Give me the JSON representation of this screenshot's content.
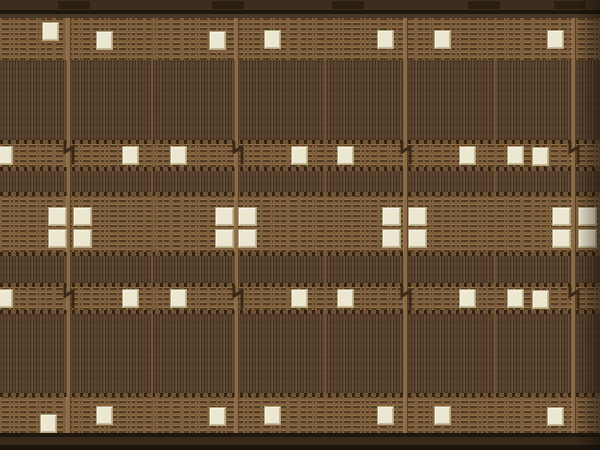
{
  "meta": {
    "description": "Photographic repeating brown texture (chip-die / woven panel): pin-striped blocks, dashed brick bands, cream square pads, tan vertical separators with zig-zag marks, dark top and bottom borders",
    "width": 600,
    "height": 450
  },
  "palette": {
    "stripe_base": "#5b4530",
    "stripe_dark": "rgba(26,16,8,0.32)",
    "stripe_light": "rgba(226,180,120,0.10)",
    "brick_base": "#7d5f3d",
    "brick_row_dark": "rgba(45,29,14,0.55)",
    "brick_highlight": "rgba(214,168,104,0.22)",
    "dots_base": "#6e5336",
    "dots_dark": "#33220f",
    "pad_fill": "#ece7d1",
    "pad_border": "#b3a478",
    "bar_top": "#3c2e1f",
    "bar_segment": "#2b1f12",
    "line_dark": "#1f160c",
    "line_mid": "#4a3826",
    "bottom_mid": "#38291a",
    "bottom_dark": "#1d140c",
    "separator_major": "#8d6b44",
    "separator_major_edge": "#5a3f26",
    "separator_minor": "#7a5b3a",
    "glyph": "#3a2817",
    "vignette": "rgba(18,11,5,0.45)"
  },
  "bands": [
    {
      "name": "top-bar",
      "type": "bar",
      "y": 0,
      "h": 10
    },
    {
      "name": "top-line",
      "type": "line-dark",
      "y": 10,
      "h": 4
    },
    {
      "name": "top-line-2",
      "type": "line-mid",
      "y": 14,
      "h": 4
    },
    {
      "name": "brick-top",
      "type": "brick",
      "y": 18,
      "h": 42
    },
    {
      "name": "stripes-1",
      "type": "stripes",
      "y": 60,
      "h": 80
    },
    {
      "name": "dots-1",
      "type": "dots",
      "y": 140,
      "h": 4
    },
    {
      "name": "brick-row2",
      "type": "brick",
      "y": 144,
      "h": 23
    },
    {
      "name": "dots-2",
      "type": "dots",
      "y": 167,
      "h": 4
    },
    {
      "name": "stripes-2",
      "type": "stripes",
      "y": 171,
      "h": 21
    },
    {
      "name": "dots-3",
      "type": "dots",
      "y": 192,
      "h": 4
    },
    {
      "name": "brick-middle",
      "type": "brick",
      "y": 196,
      "h": 56
    },
    {
      "name": "dots-4",
      "type": "dots",
      "y": 252,
      "h": 4
    },
    {
      "name": "stripes-3",
      "type": "stripes",
      "y": 256,
      "h": 27
    },
    {
      "name": "dots-5",
      "type": "dots",
      "y": 283,
      "h": 4
    },
    {
      "name": "brick-row3",
      "type": "brick",
      "y": 287,
      "h": 23
    },
    {
      "name": "dots-6",
      "type": "dots",
      "y": 310,
      "h": 4
    },
    {
      "name": "stripes-4",
      "type": "stripes",
      "y": 314,
      "h": 79
    },
    {
      "name": "dots-7",
      "type": "dots",
      "y": 393,
      "h": 4
    },
    {
      "name": "brick-bottom",
      "type": "brick",
      "y": 397,
      "h": 36
    },
    {
      "name": "bottom-line",
      "type": "line-dark",
      "y": 433,
      "h": 4
    },
    {
      "name": "bottom-bar",
      "type": "bottom-mid",
      "y": 437,
      "h": 8
    },
    {
      "name": "bottom-edge",
      "type": "bottom-dark",
      "y": 445,
      "h": 5
    }
  ],
  "separators": {
    "major": {
      "xs": [
        66,
        234,
        403,
        571
      ],
      "width": 5,
      "y": 18,
      "h": 415
    },
    "minor": {
      "xs": [
        151,
        324,
        494
      ],
      "width": 2,
      "y": 18,
      "h": 415
    }
  },
  "top_bar_segments": {
    "y": 1,
    "h": 8,
    "w": 32,
    "xs": [
      58,
      212,
      332,
      468,
      554
    ]
  },
  "pads": {
    "size": {
      "w": 17,
      "h": 19
    },
    "row1": [
      {
        "x": 42,
        "y": 22
      },
      {
        "x": 96,
        "y": 31
      },
      {
        "x": 209,
        "y": 31
      },
      {
        "x": 264,
        "y": 30
      },
      {
        "x": 377,
        "y": 30
      },
      {
        "x": 434,
        "y": 30
      },
      {
        "x": 547,
        "y": 30
      }
    ],
    "row2": [
      {
        "x": -4,
        "y": 146
      },
      {
        "x": 122,
        "y": 146
      },
      {
        "x": 170,
        "y": 146
      },
      {
        "x": 291,
        "y": 146
      },
      {
        "x": 337,
        "y": 146
      },
      {
        "x": 459,
        "y": 146
      },
      {
        "x": 507,
        "y": 146
      },
      {
        "x": 532,
        "y": 147
      }
    ],
    "row3": [
      {
        "x": -4,
        "y": 289
      },
      {
        "x": 122,
        "y": 289
      },
      {
        "x": 170,
        "y": 289
      },
      {
        "x": 291,
        "y": 289
      },
      {
        "x": 337,
        "y": 289
      },
      {
        "x": 459,
        "y": 289
      },
      {
        "x": 507,
        "y": 289
      },
      {
        "x": 532,
        "y": 290
      }
    ],
    "row4": [
      {
        "x": 40,
        "y": 414
      },
      {
        "x": 96,
        "y": 406
      },
      {
        "x": 209,
        "y": 407
      },
      {
        "x": 264,
        "y": 406
      },
      {
        "x": 377,
        "y": 406
      },
      {
        "x": 434,
        "y": 406
      },
      {
        "x": 547,
        "y": 407
      }
    ],
    "clusters": {
      "w": 19,
      "h": 19,
      "row_ys": [
        207,
        229
      ],
      "col_xs": [
        [
          48,
          73
        ],
        [
          215,
          238
        ],
        [
          382,
          408
        ],
        [
          552,
          578
        ]
      ]
    }
  },
  "glyphs": {
    "w": 14,
    "h": 24,
    "points": "3,2 3,11 11,6 11,22",
    "rows": [
      {
        "y": 141,
        "xs": [
          62,
          231,
          399,
          567
        ]
      },
      {
        "y": 285,
        "xs": [
          62,
          231,
          399,
          567
        ]
      }
    ]
  }
}
